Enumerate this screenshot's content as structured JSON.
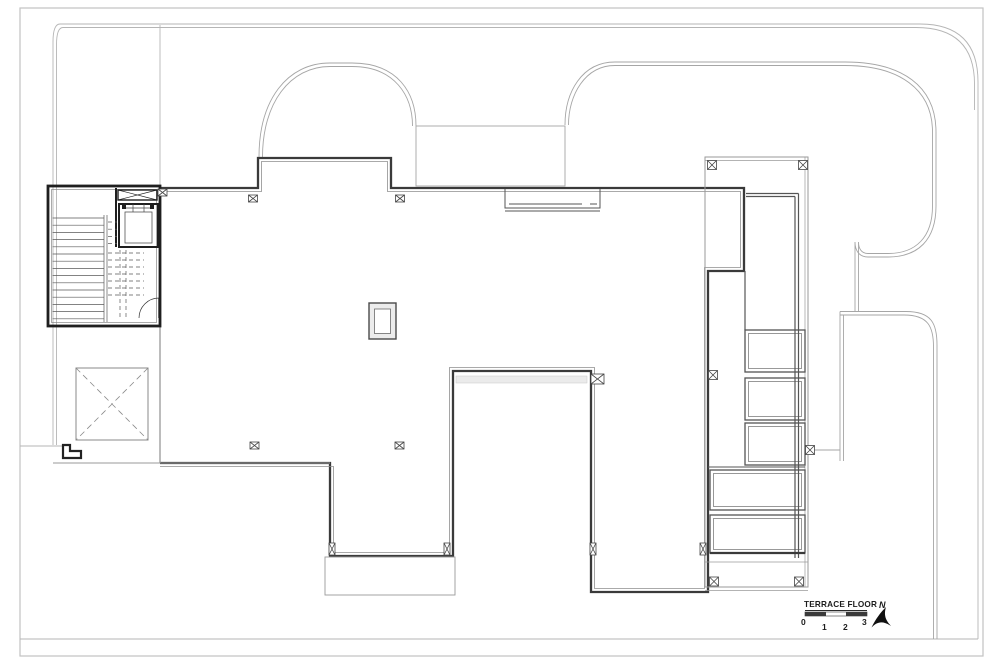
{
  "drawing": {
    "label": "TERRACE FLOOR",
    "scale_bar": {
      "ticks": [
        "0",
        "1",
        "2",
        "3"
      ]
    },
    "north": {
      "label": "N"
    }
  },
  "colors": {
    "background": "#ffffff",
    "border": "#c2c2c2",
    "site": "#b5b5b5",
    "roof": "#a6a6a6",
    "wall_dark": "#3a3a3a",
    "wall_inner": "#8f8f8f",
    "stair_black": "#1f1f1f",
    "detail": "#555555",
    "thin": "#9a9a9a",
    "marker": "#444444",
    "text": "#1c1c1c"
  }
}
